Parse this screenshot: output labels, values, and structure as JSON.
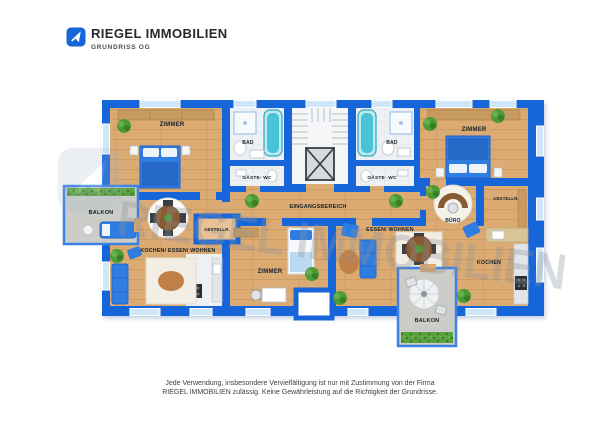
{
  "header": {
    "brand": "RIEGEL IMMOBILIEN",
    "subtitle": "GRUNDRISS OG",
    "logo_icon": "house-arrow-icon"
  },
  "watermark": {
    "text": "RIEGEL IMMOBILIEN"
  },
  "colors": {
    "wall": "#1766d9",
    "window": "#cfe7fa",
    "wood_floor": "#dcab74",
    "tile_floor": "#eef1f4",
    "balcony_floor": "#cccdc8",
    "furniture_blue": "#2f7de0",
    "tub_teal": "#49c3d6",
    "plant_green": "#4d9b37",
    "label_text": "#16212e"
  },
  "rooms": {
    "zimmer_tl": {
      "label": "ZIMMER"
    },
    "bad_l": {
      "label": "BAD"
    },
    "gwc_l": {
      "label": "GÄSTE- WC"
    },
    "balkon_l": {
      "label": "BALKON"
    },
    "kew": {
      "label": "KOCHEN/ ESSEN/ WOHNEN"
    },
    "abstell_l": {
      "label": "ABSTELLR."
    },
    "hall": {
      "label": "EINGANGSBEREICH"
    },
    "bad_r": {
      "label": "BAD"
    },
    "gwc_r": {
      "label": "GÄSTE- WC"
    },
    "zimmer_tr": {
      "label": "ZIMMER"
    },
    "buero": {
      "label": "BÜRO"
    },
    "abstell_r": {
      "label": "ABSTELLR."
    },
    "essen": {
      "label": "ESSEN/ WOHNEN"
    },
    "kochen": {
      "label": "KOCHEN"
    },
    "zimmer_b": {
      "label": "ZIMMER"
    },
    "balkon_b": {
      "label": "BALKON"
    }
  },
  "disclaimer": {
    "line1": "Jede Verwendung, insbesondere Vervielfältigung ist nur mit Zustimmung von der Firma",
    "line2": "RIEGEL IMMOBILIEN zulässig. Keine Gewährleistung auf die Richtigkeit der Grundrisse."
  }
}
